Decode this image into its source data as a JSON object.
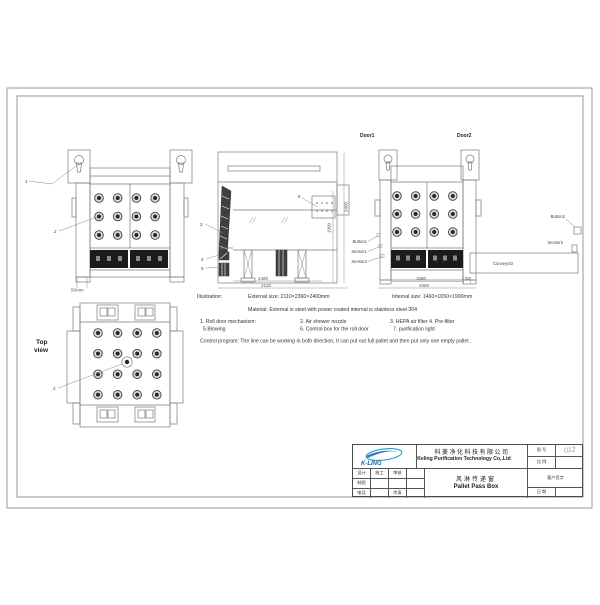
{
  "top_view": {
    "title_line1": "Top",
    "title_line2": "view"
  },
  "callouts": {
    "n1": "1",
    "n2_left": "2",
    "n2_mid": "2",
    "n4": "4",
    "n5": "5",
    "n6": "6",
    "n2_top": "2",
    "door1": "Door1",
    "door2": "Door2",
    "button1": "Button1",
    "sensor1": "Sensor1",
    "sensor2": "Sensor2",
    "button2": "Button2",
    "sensor2_right": "Sensor2",
    "conveyor2": "Conveyor2"
  },
  "dimensions": {
    "front_left_base": "50mm",
    "side_width_inner": "1480",
    "side_width_outer": "2110",
    "side_height_outer": "2400",
    "side_height_inner": "1900",
    "right_width_inner": "1860",
    "right_width_outer": "2360",
    "right_gap": "50"
  },
  "notes": {
    "illustration": "Illustration:",
    "external_size": "External size:   2110×2360×2400mm",
    "internal_size": "Internal size:   1460×1650×1900mm",
    "material": "Material:   External is steel with power coated internal is stainless steel 304",
    "item_1": "1. Roll door mechanism:",
    "item_2": "2. Air shower nozzle",
    "item_3_4": "3. HEPA air filter   4. Pre-filter",
    "item_5": "5.Blowing",
    "item_6": "6. Control box for the roll door",
    "item_7": "7. purification light",
    "control_program": "Control program:  The line can be working in both direction, It can put out full pallet and then put only one empty pallet ."
  },
  "title_block": {
    "logo_text": "K-LING",
    "company_cn": "科菱净化科技有限公司",
    "company_en": "Keling Purification Technology Co,.Ltd",
    "drawing_no_label": "图 号",
    "drawing_no_value": "012",
    "scale_label": "比 例",
    "customer_sign_label": "客户签字",
    "date_label": "日 期",
    "design_label": "设计",
    "construction_label": "施工",
    "review_label": "审核",
    "drafting_label": "制图",
    "phone_label": "电话",
    "fax_label": "传真",
    "product_cn": "风淋传递窗",
    "product_en": "Pallet Pass Box"
  },
  "colors": {
    "line": "#7a7a7a",
    "dark_fill": "#1b1b1b",
    "logo_blue": "#1668b4",
    "logo_teal": "#2f9bc1",
    "handwriting": "#999999"
  }
}
